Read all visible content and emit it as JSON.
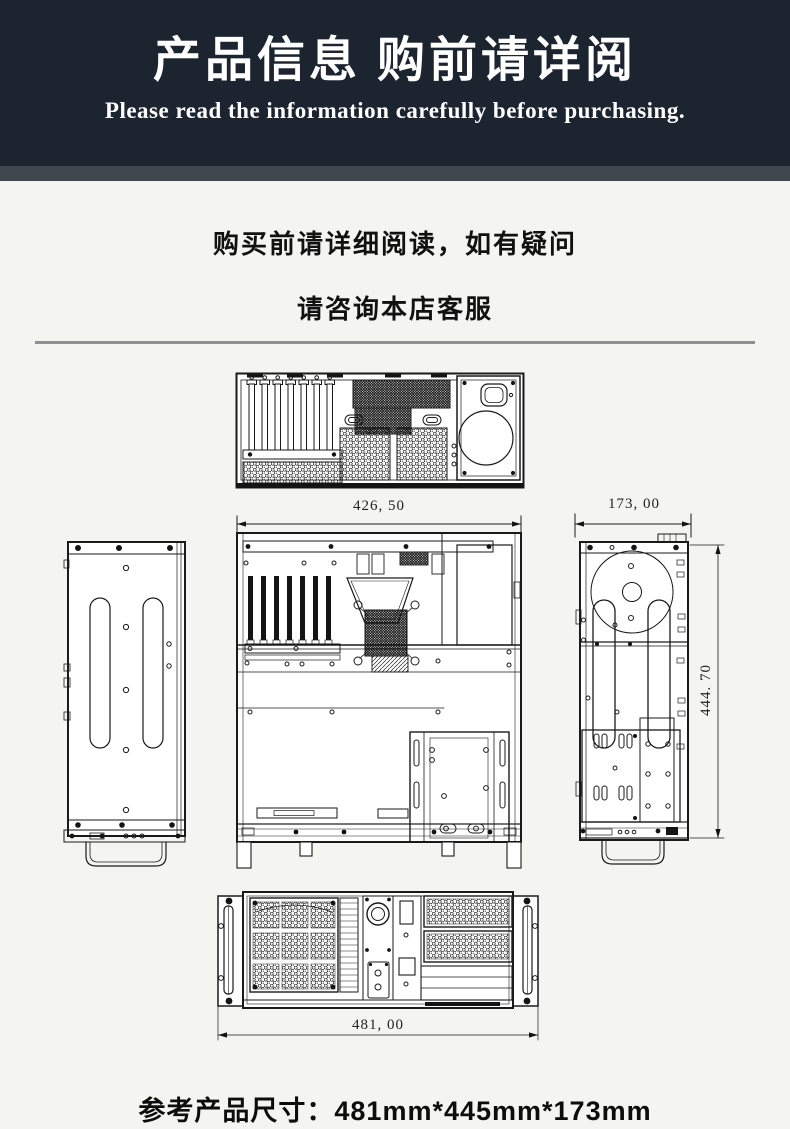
{
  "banner": {
    "title": "产品信息 购前请详阅",
    "subtitle": "Please read the information carefully before purchasing."
  },
  "notice": {
    "line1": "购买前请详细阅读，如有疑问",
    "line2": "请咨询本店客服"
  },
  "diagram": {
    "dim_top_width": "426, 50",
    "dim_side_width": "173, 00",
    "dim_side_height": "444. 70",
    "dim_front_width": "481, 00"
  },
  "footer": {
    "note": "参考产品尺寸：481mm*445mm*173mm"
  },
  "colors": {
    "banner_bg": "#1c2430",
    "strip_bg": "#40474f",
    "page_bg": "#f4f4f1"
  }
}
